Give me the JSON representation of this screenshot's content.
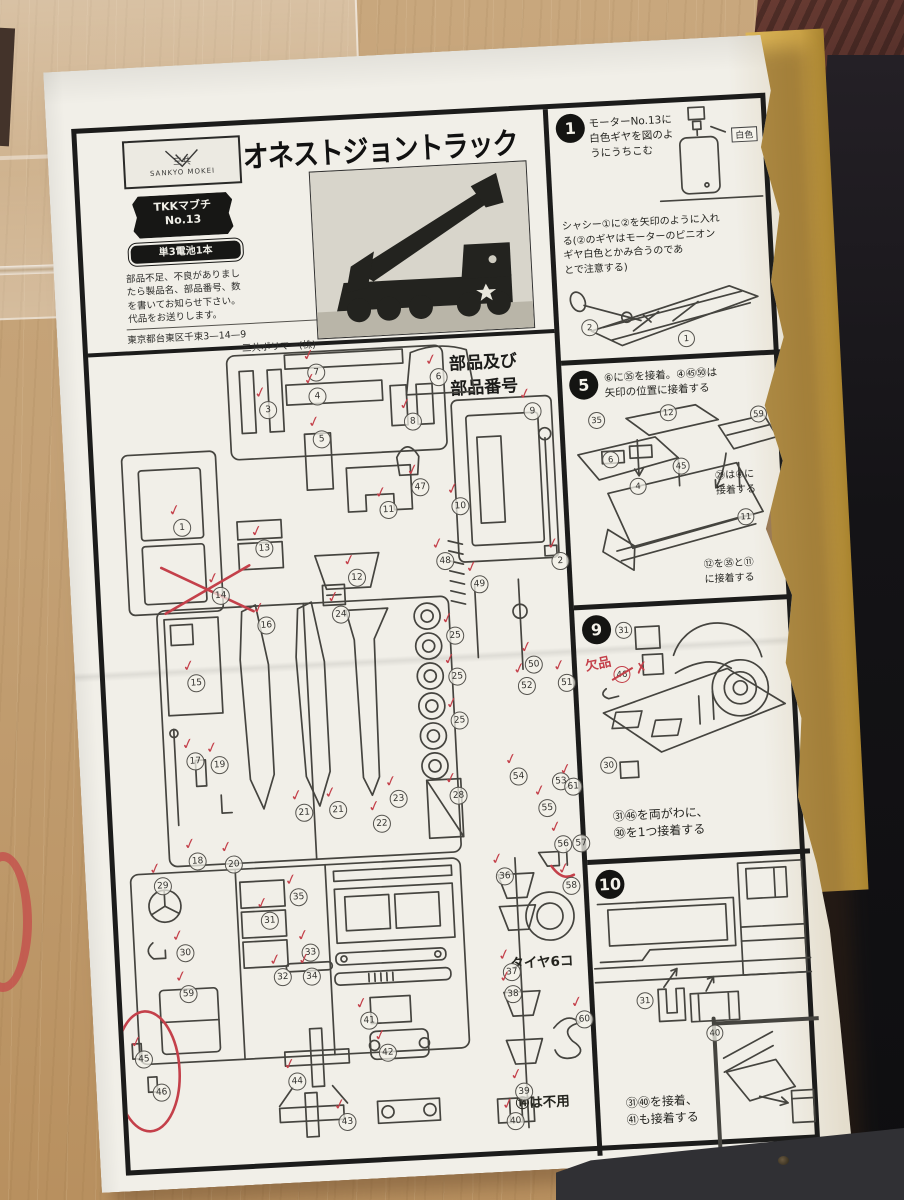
{
  "colors": {
    "check_red": "#c4404a",
    "paper": "#f1efe8",
    "ink": "#1c1c1b",
    "wood": "#c3a074",
    "cardboard": "#caa246"
  },
  "header": {
    "logo_title": "三共",
    "logo_subtitle": "SANKYO MOKEI",
    "title": "オネストジョントラック",
    "badge_motor_line1": "TKKマブチ",
    "badge_motor_line2": "No.13",
    "badge_battery": "単3電池1本",
    "notice_lines": [
      "部品不足、不良がありまし",
      "たら製品名、部品番号、数",
      "を書いてお知らせ下さい。",
      "代品をお送りします。"
    ],
    "address_line1": "東京都台東区千束3—14—9",
    "address_line2": "三共ポリマー(株)"
  },
  "parts_section": {
    "heading_line1": "部品及び",
    "heading_line2": "部品番号",
    "tire_note": "タイヤ6コ",
    "unused_note": "⑭は不用",
    "check_glyph": "✓",
    "parts": [
      {
        "n": "7",
        "x": 218,
        "y": 14,
        "c": true
      },
      {
        "n": "4",
        "x": 218,
        "y": 38,
        "c": true
      },
      {
        "n": "6",
        "x": 340,
        "y": 25,
        "c": true
      },
      {
        "n": "3",
        "x": 168,
        "y": 49,
        "c": true
      },
      {
        "n": "5",
        "x": 220,
        "y": 81,
        "c": true
      },
      {
        "n": "8",
        "x": 312,
        "y": 68,
        "c": true
      },
      {
        "n": "9",
        "x": 432,
        "y": 64,
        "c": true
      },
      {
        "n": "1",
        "x": 76,
        "y": 162,
        "c": true
      },
      {
        "n": "13",
        "x": 157,
        "y": 187,
        "c": true
      },
      {
        "n": "11",
        "x": 283,
        "y": 155,
        "c": true
      },
      {
        "n": "47",
        "x": 316,
        "y": 134,
        "c": true
      },
      {
        "n": "10",
        "x": 355,
        "y": 155,
        "c": true
      },
      {
        "n": "12",
        "x": 248,
        "y": 221,
        "c": true
      },
      {
        "n": "48",
        "x": 337,
        "y": 209,
        "c": true
      },
      {
        "n": "14",
        "x": 111,
        "y": 232,
        "c": true
      },
      {
        "n": "2",
        "x": 452,
        "y": 215,
        "c": true
      },
      {
        "n": "49",
        "x": 370,
        "y": 234,
        "c": true
      },
      {
        "n": "16",
        "x": 155,
        "y": 264,
        "c": true
      },
      {
        "n": "24",
        "x": 230,
        "y": 257,
        "c": true
      },
      {
        "n": "25",
        "x": 343,
        "y": 284,
        "c": true
      },
      {
        "n": "15",
        "x": 82,
        "y": 318,
        "c": true
      },
      {
        "n": "25",
        "x": 343,
        "y": 325,
        "c": true
      },
      {
        "n": "25",
        "x": 343,
        "y": 369,
        "c": true
      },
      {
        "n": "50",
        "x": 420,
        "y": 317,
        "c": true
      },
      {
        "n": "52",
        "x": 412,
        "y": 338,
        "c": true
      },
      {
        "n": "51",
        "x": 452,
        "y": 337,
        "c": true
      },
      {
        "n": "17",
        "x": 77,
        "y": 396,
        "c": true
      },
      {
        "n": "19",
        "x": 101,
        "y": 401,
        "c": true
      },
      {
        "n": "21",
        "x": 183,
        "y": 453,
        "c": true
      },
      {
        "n": "21",
        "x": 217,
        "y": 452,
        "c": true
      },
      {
        "n": "23",
        "x": 278,
        "y": 444,
        "c": true
      },
      {
        "n": "28",
        "x": 338,
        "y": 444,
        "c": true
      },
      {
        "n": "54",
        "x": 399,
        "y": 428,
        "c": true
      },
      {
        "n": "53",
        "x": 441,
        "y": 435,
        "c": false
      },
      {
        "n": "61",
        "x": 453,
        "y": 441,
        "c": true
      },
      {
        "n": "22",
        "x": 260,
        "y": 468,
        "c": true
      },
      {
        "n": "55",
        "x": 426,
        "y": 461,
        "c": true
      },
      {
        "n": "18",
        "x": 74,
        "y": 496,
        "c": true
      },
      {
        "n": "20",
        "x": 110,
        "y": 501,
        "c": true
      },
      {
        "n": "56",
        "x": 440,
        "y": 498,
        "c": true
      },
      {
        "n": "57",
        "x": 458,
        "y": 498,
        "c": false
      },
      {
        "n": "29",
        "x": 38,
        "y": 519,
        "c": true
      },
      {
        "n": "35",
        "x": 173,
        "y": 537,
        "c": true
      },
      {
        "n": "31",
        "x": 143,
        "y": 559,
        "c": true
      },
      {
        "n": "30",
        "x": 57,
        "y": 587,
        "c": true
      },
      {
        "n": "33",
        "x": 182,
        "y": 593,
        "c": true
      },
      {
        "n": "32",
        "x": 153,
        "y": 616,
        "c": true
      },
      {
        "n": "34",
        "x": 182,
        "y": 617,
        "c": true
      },
      {
        "n": "59",
        "x": 58,
        "y": 628,
        "c": true
      },
      {
        "n": "36",
        "x": 380,
        "y": 527,
        "c": true
      },
      {
        "n": "37",
        "x": 382,
        "y": 623,
        "c": true
      },
      {
        "n": "38",
        "x": 382,
        "y": 645,
        "c": true
      },
      {
        "n": "58",
        "x": 446,
        "y": 540,
        "c": true
      },
      {
        "n": "41",
        "x": 237,
        "y": 664,
        "c": true
      },
      {
        "n": "42",
        "x": 254,
        "y": 697,
        "c": true
      },
      {
        "n": "45",
        "x": 10,
        "y": 691,
        "c": true
      },
      {
        "n": "46",
        "x": 26,
        "y": 725,
        "c": false
      },
      {
        "n": "44",
        "x": 162,
        "y": 721,
        "c": true
      },
      {
        "n": "43",
        "x": 210,
        "y": 764,
        "c": true
      },
      {
        "n": "39",
        "x": 388,
        "y": 743,
        "c": true
      },
      {
        "n": "40",
        "x": 378,
        "y": 772,
        "c": true
      },
      {
        "n": "60",
        "x": 452,
        "y": 674,
        "c": true
      }
    ]
  },
  "steps": [
    {
      "num": "1",
      "lines": [
        "モーターNo.13に",
        "白色ギヤを図のよ",
        "うにうちこむ"
      ],
      "white_label": "白色",
      "lines2": [
        "シャシー①に②を矢印のように入れ",
        "る(②のギヤはモーターのピニオン",
        "ギヤ白色とかみ合うのであ",
        "とで注意する)"
      ],
      "axle_label": "2",
      "chassis_label": "1"
    },
    {
      "num": "5",
      "lines": [
        "⑥に㉟を接着。④㊺㊿は",
        "矢印の位置に接着する"
      ],
      "labels": [
        "35",
        "12",
        "59",
        "6",
        "45",
        "4"
      ],
      "note_a": [
        "㉙は④に",
        "接着する"
      ],
      "note_a_label": "11",
      "note_b": [
        "⑫を㉟と⑪",
        "に接着する"
      ]
    },
    {
      "num": "9",
      "lines": [
        "㉛㊻を両がわに、",
        "㉚を1つ接着する"
      ],
      "missing_note": "欠品",
      "labels": [
        "31",
        "46",
        "30"
      ]
    },
    {
      "num": "10",
      "lines": [
        "㉛㊵を接着、",
        "㊶も接着する"
      ],
      "labels": [
        "31",
        "40"
      ]
    }
  ],
  "edge_panels": {
    "top": "2",
    "middle": "6"
  }
}
